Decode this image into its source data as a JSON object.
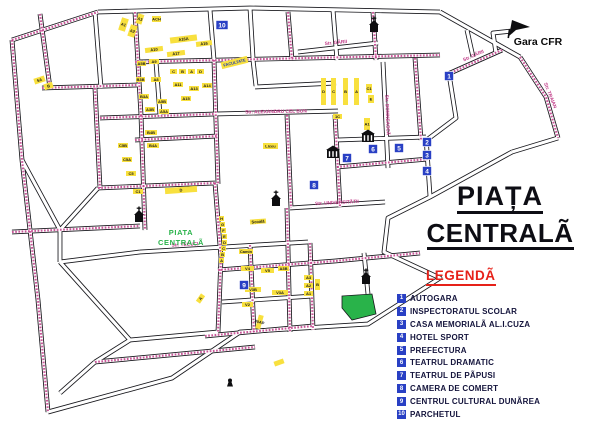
{
  "title": {
    "line1": "PIAȚA",
    "line2": "CENTRALÃ"
  },
  "legend": {
    "heading": "LEGENDÃ",
    "items": [
      {
        "n": "1",
        "label": "AUTOGARA"
      },
      {
        "n": "2",
        "label": "INSPECTORATUL SCOLAR"
      },
      {
        "n": "3",
        "label": "CASA MEMORIALÃ AL.I.CUZA"
      },
      {
        "n": "4",
        "label": "HOTEL SPORT"
      },
      {
        "n": "5",
        "label": "PREFECTURA"
      },
      {
        "n": "6",
        "label": "TEATRUL DRAMATIC"
      },
      {
        "n": "7",
        "label": "TEATRUL DE PÃPUSI"
      },
      {
        "n": "8",
        "label": "CAMERA DE COMERT"
      },
      {
        "n": "9",
        "label": "CENTRUL CULTURAL DUNÃREA"
      },
      {
        "n": "10",
        "label": "PARCHETUL"
      }
    ]
  },
  "map": {
    "colors": {
      "line": "#17171c",
      "street_fill": "#ffffff",
      "street_name": "#c03a87",
      "building": "#f8e03e",
      "building_text": "#1a1a1a",
      "marker": "#2940c4",
      "marker_text": "#ffffff",
      "green": "#29b34a",
      "icon": "#0e0e10"
    },
    "gara": {
      "label": "Gara CFR",
      "x": 538,
      "y": 45,
      "icon_x": 509,
      "icon_y": 20
    },
    "piata_label": {
      "line1": "PIATA",
      "line2": "CENTRALÃ",
      "x": 181,
      "y": 235
    },
    "park": [
      [
        342,
        296
      ],
      [
        372,
        294
      ],
      [
        376,
        314
      ],
      [
        352,
        320
      ],
      [
        342,
        308
      ]
    ],
    "streets": [
      {
        "p": [
          [
            12,
            40
          ],
          [
            98,
            12
          ]
        ],
        "d": 1
      },
      {
        "p": [
          [
            98,
            12
          ],
          [
            250,
            8
          ],
          [
            440,
            12
          ]
        ]
      },
      {
        "p": [
          [
            440,
            12
          ],
          [
            520,
            57
          ]
        ]
      },
      {
        "p": [
          [
            520,
            57
          ],
          [
            546,
            97
          ],
          [
            558,
            138
          ]
        ],
        "d": 1,
        "t": "Str. TRAIAN",
        "tx": 549,
        "ty": 96,
        "ta": 68
      },
      {
        "p": [
          [
            558,
            138
          ],
          [
            512,
            152
          ]
        ]
      },
      {
        "p": [
          [
            512,
            152
          ],
          [
            430,
            197
          ],
          [
            388,
            218
          ],
          [
            384,
            252
          ],
          [
            440,
            278
          ],
          [
            368,
            324
          ],
          [
            240,
            332
          ],
          [
            172,
            378
          ],
          [
            48,
            412
          ]
        ]
      },
      {
        "p": [
          [
            12,
            40
          ],
          [
            22,
            160
          ],
          [
            38,
            300
          ],
          [
            48,
            412
          ]
        ],
        "d": 1
      },
      {
        "p": [
          [
            448,
            74
          ],
          [
            502,
            50
          ]
        ],
        "d": 1,
        "t": "Str. GÃRII",
        "tx": 474,
        "ty": 57,
        "ta": -24
      },
      {
        "p": [
          [
            496,
            53
          ],
          [
            493,
            33
          ],
          [
            512,
            31
          ]
        ]
      },
      {
        "p": [
          [
            449,
            74
          ],
          [
            456,
            118
          ],
          [
            428,
            139
          ]
        ]
      },
      {
        "p": [
          [
            298,
            52
          ],
          [
            378,
            43
          ]
        ],
        "t": "Str. GÃRII",
        "tx": 336,
        "ty": 44,
        "ta": -6
      },
      {
        "p": [
          [
            40,
            14
          ],
          [
            50,
            88
          ]
        ],
        "d": 1
      },
      {
        "p": [
          [
            95,
            12
          ],
          [
            101,
            88
          ]
        ]
      },
      {
        "p": [
          [
            42,
            88
          ],
          [
            138,
            85
          ]
        ],
        "d": 1
      },
      {
        "p": [
          [
            135,
            12
          ],
          [
            141,
            115
          ]
        ],
        "d": 1
      },
      {
        "p": [
          [
            141,
            115
          ],
          [
            145,
            230
          ]
        ],
        "d": 1
      },
      {
        "p": [
          [
            210,
            10
          ],
          [
            214,
            60
          ]
        ]
      },
      {
        "p": [
          [
            214,
            60
          ],
          [
            218,
            184
          ]
        ],
        "d": 1
      },
      {
        "p": [
          [
            250,
            8
          ],
          [
            253,
            58
          ]
        ]
      },
      {
        "p": [
          [
            288,
            12
          ],
          [
            292,
            60
          ]
        ],
        "d": 1
      },
      {
        "p": [
          [
            333,
            10
          ],
          [
            337,
            60
          ]
        ]
      },
      {
        "p": [
          [
            373,
            12
          ],
          [
            376,
            60
          ]
        ],
        "d": 1
      },
      {
        "p": [
          [
            135,
            62
          ],
          [
            440,
            55
          ]
        ],
        "d": 1
      },
      {
        "p": [
          [
            156,
            62
          ],
          [
            160,
            115
          ]
        ]
      },
      {
        "p": [
          [
            253,
            60
          ],
          [
            256,
            86
          ]
        ]
      },
      {
        "p": [
          [
            255,
            87
          ],
          [
            336,
            83
          ]
        ]
      },
      {
        "p": [
          [
            100,
            118
          ],
          [
            215,
            114
          ]
        ],
        "d": 1
      },
      {
        "p": [
          [
            215,
            114
          ],
          [
            338,
            111
          ]
        ],
        "t": "Str. ALEXANDRU CEL BUN",
        "tx": 276,
        "ty": 113,
        "ta": -1
      },
      {
        "p": [
          [
            383,
            62
          ],
          [
            388,
            168
          ]
        ],
        "t": "Str. DOMNEASCÃ",
        "tx": 386,
        "ty": 115,
        "ta": 88
      },
      {
        "p": [
          [
            415,
            58
          ],
          [
            421,
            140
          ]
        ],
        "d": 1
      },
      {
        "p": [
          [
            467,
            30
          ],
          [
            473,
            57
          ]
        ]
      },
      {
        "p": [
          [
            135,
            140
          ],
          [
            218,
            136
          ]
        ],
        "d": 1
      },
      {
        "p": [
          [
            337,
            140
          ],
          [
            426,
            137
          ]
        ]
      },
      {
        "p": [
          [
            426,
            137
          ],
          [
            430,
            196
          ]
        ]
      },
      {
        "p": [
          [
            337,
            167
          ],
          [
            428,
            159
          ]
        ],
        "d": 1
      },
      {
        "p": [
          [
            98,
            188
          ],
          [
            215,
            183
          ]
        ],
        "d": 1
      },
      {
        "p": [
          [
            95,
            88
          ],
          [
            100,
            188
          ]
        ],
        "d": 1
      },
      {
        "p": [
          [
            290,
            208
          ],
          [
            385,
            202
          ]
        ],
        "t": "Str. UNIVERSITÃTII",
        "tx": 337,
        "ty": 204,
        "ta": -3
      },
      {
        "p": [
          [
            287,
            115
          ],
          [
            291,
            208
          ]
        ],
        "d": 1
      },
      {
        "p": [
          [
            335,
            115
          ],
          [
            340,
            207
          ]
        ],
        "d": 1
      },
      {
        "p": [
          [
            12,
            232
          ],
          [
            140,
            226
          ]
        ],
        "d": 1
      },
      {
        "p": [
          [
            60,
            262
          ],
          [
            140,
            252
          ]
        ]
      },
      {
        "p": [
          [
            140,
            252
          ],
          [
            308,
            242
          ]
        ],
        "t": "Str. TECUCI",
        "tx": 185,
        "ty": 246,
        "ta": -3
      },
      {
        "p": [
          [
            215,
            183
          ],
          [
            221,
            258
          ],
          [
            218,
            332
          ]
        ],
        "d": 1
      },
      {
        "p": [
          [
            218,
            270
          ],
          [
            335,
            261
          ],
          [
            420,
            253
          ]
        ],
        "d": 1
      },
      {
        "p": [
          [
            364,
            253
          ],
          [
            368,
            294
          ]
        ]
      },
      {
        "p": [
          [
            250,
            245
          ],
          [
            254,
            332
          ]
        ],
        "d": 1
      },
      {
        "p": [
          [
            287,
            208
          ],
          [
            290,
            332
          ]
        ],
        "d": 1
      },
      {
        "p": [
          [
            310,
            243
          ],
          [
            313,
            330
          ]
        ],
        "d": 1
      },
      {
        "p": [
          [
            222,
            302
          ],
          [
            313,
            296
          ]
        ]
      },
      {
        "p": [
          [
            205,
            336
          ],
          [
            313,
            326
          ]
        ],
        "d": 1
      },
      {
        "p": [
          [
            95,
            362
          ],
          [
            255,
            347
          ]
        ],
        "d": 1
      },
      {
        "p": [
          [
            95,
            362
          ],
          [
            60,
            393
          ]
        ]
      },
      {
        "p": [
          [
            60,
            230
          ],
          [
            98,
            188
          ]
        ]
      },
      {
        "p": [
          [
            22,
            160
          ],
          [
            60,
            230
          ]
        ]
      },
      {
        "p": [
          [
            60,
            230
          ],
          [
            60,
            262
          ]
        ]
      },
      {
        "p": [
          [
            60,
            262
          ],
          [
            130,
            340
          ]
        ]
      },
      {
        "p": [
          [
            130,
            340
          ],
          [
            218,
            332
          ]
        ]
      },
      {
        "p": [
          [
            130,
            340
          ],
          [
            95,
            362
          ]
        ]
      }
    ],
    "buildings": [
      [
        120,
        18,
        7,
        13,
        18,
        "A1"
      ],
      [
        129,
        25,
        7,
        12,
        18,
        "A2"
      ],
      [
        137,
        14,
        6,
        10,
        18,
        "A3"
      ],
      [
        152,
        16,
        9,
        6,
        0,
        "ACH"
      ],
      [
        34,
        77,
        11,
        6,
        -18,
        "5A"
      ],
      [
        44,
        83,
        9,
        6,
        -18,
        "B"
      ],
      [
        170,
        36,
        27,
        6,
        -7,
        "A16A"
      ],
      [
        196,
        41,
        16,
        5,
        -7,
        "A16"
      ],
      [
        145,
        47,
        18,
        5,
        -7,
        "A10"
      ],
      [
        167,
        51,
        18,
        5,
        -7,
        "A17"
      ],
      [
        137,
        61,
        9,
        5,
        0,
        "A5B"
      ],
      [
        149,
        59,
        10,
        5,
        0,
        "A9"
      ],
      [
        170,
        69,
        7,
        5,
        0,
        "C"
      ],
      [
        179,
        69,
        7,
        5,
        0,
        "B"
      ],
      [
        188,
        69,
        7,
        5,
        0,
        "A"
      ],
      [
        197,
        69,
        7,
        5,
        0,
        "D"
      ],
      [
        136,
        77,
        9,
        5,
        0,
        "B3B"
      ],
      [
        151,
        77,
        10,
        5,
        0,
        "A8"
      ],
      [
        173,
        82,
        10,
        5,
        0,
        "A11"
      ],
      [
        189,
        86,
        10,
        5,
        0,
        "A13"
      ],
      [
        202,
        83,
        10,
        5,
        0,
        "A14"
      ],
      [
        139,
        94,
        10,
        5,
        0,
        "B3A"
      ],
      [
        181,
        96,
        10,
        5,
        0,
        "A15"
      ],
      [
        157,
        99,
        10,
        5,
        0,
        "A5B"
      ],
      [
        145,
        107,
        10,
        5,
        0,
        "A3B"
      ],
      [
        159,
        109,
        10,
        5,
        0,
        "A5A"
      ],
      [
        221,
        59,
        27,
        7,
        -14,
        "FACULTATE",
        "#1d3cb8"
      ],
      [
        145,
        130,
        12,
        5,
        0,
        "B4B"
      ],
      [
        147,
        143,
        12,
        5,
        0,
        "B4A"
      ],
      [
        118,
        143,
        10,
        5,
        0,
        "C5B"
      ],
      [
        122,
        157,
        10,
        5,
        0,
        "C5A"
      ],
      [
        126,
        171,
        10,
        5,
        0,
        "C5"
      ],
      [
        133,
        189,
        10,
        5,
        0,
        "C1"
      ],
      [
        165,
        187,
        32,
        6,
        -4,
        "D"
      ],
      [
        321,
        78,
        5,
        27,
        0,
        "D"
      ],
      [
        331,
        78,
        5,
        27,
        0,
        "C"
      ],
      [
        343,
        78,
        5,
        27,
        0,
        "B"
      ],
      [
        354,
        78,
        5,
        27,
        0,
        "A"
      ],
      [
        366,
        84,
        6,
        9,
        0,
        "C1"
      ],
      [
        368,
        95,
        6,
        8,
        0,
        "E"
      ],
      [
        333,
        114,
        9,
        5,
        0,
        "1C"
      ],
      [
        364,
        118,
        6,
        12,
        0,
        "A1"
      ],
      [
        263,
        143,
        15,
        6,
        0,
        "Liceu"
      ],
      [
        219,
        216,
        5,
        5,
        0,
        "H"
      ],
      [
        220,
        222,
        5,
        5,
        0,
        "G"
      ],
      [
        221,
        228,
        5,
        5,
        0,
        "F"
      ],
      [
        222,
        234,
        5,
        5,
        0,
        "E"
      ],
      [
        222,
        240,
        5,
        5,
        0,
        "D"
      ],
      [
        221,
        246,
        5,
        5,
        0,
        "C"
      ],
      [
        220,
        252,
        5,
        5,
        0,
        "B"
      ],
      [
        219,
        258,
        5,
        5,
        0,
        "A"
      ],
      [
        250,
        219,
        16,
        5,
        -4,
        "Scoalã"
      ],
      [
        239,
        249,
        14,
        5,
        0,
        "Camin"
      ],
      [
        241,
        266,
        13,
        5,
        0,
        "V4"
      ],
      [
        261,
        268,
        13,
        5,
        0,
        "V5"
      ],
      [
        278,
        266,
        11,
        5,
        0,
        "A3B"
      ],
      [
        245,
        287,
        16,
        5,
        0,
        "V3B"
      ],
      [
        272,
        290,
        16,
        5,
        0,
        "V3A"
      ],
      [
        242,
        302,
        11,
        5,
        0,
        "V2"
      ],
      [
        257,
        315,
        5,
        14,
        15,
        "40AP"
      ],
      [
        304,
        275,
        9,
        5,
        0,
        "A3"
      ],
      [
        304,
        283,
        9,
        5,
        0,
        "A2"
      ],
      [
        304,
        291,
        9,
        5,
        0,
        "A1"
      ],
      [
        315,
        279,
        5,
        11,
        0,
        "B"
      ],
      [
        196,
        296,
        9,
        5,
        -55,
        "A"
      ],
      [
        274,
        360,
        10,
        5,
        -20,
        ""
      ]
    ],
    "markers": [
      {
        "n": "1",
        "x": 449,
        "y": 76
      },
      {
        "n": "2",
        "x": 427,
        "y": 142
      },
      {
        "n": "3",
        "x": 427,
        "y": 155
      },
      {
        "n": "4",
        "x": 427,
        "y": 171
      },
      {
        "n": "5",
        "x": 399,
        "y": 148
      },
      {
        "n": "6",
        "x": 373,
        "y": 149
      },
      {
        "n": "7",
        "x": 347,
        "y": 158
      },
      {
        "n": "8",
        "x": 314,
        "y": 185
      },
      {
        "n": "9",
        "x": 244,
        "y": 285
      },
      {
        "n": "10",
        "x": 222,
        "y": 25
      }
    ],
    "churches": [
      [
        374,
        26
      ],
      [
        139,
        216
      ],
      [
        276,
        200
      ],
      [
        366,
        278
      ]
    ],
    "theaters": [
      [
        368,
        136
      ],
      [
        333,
        152
      ]
    ],
    "monument": [
      230,
      384
    ]
  }
}
